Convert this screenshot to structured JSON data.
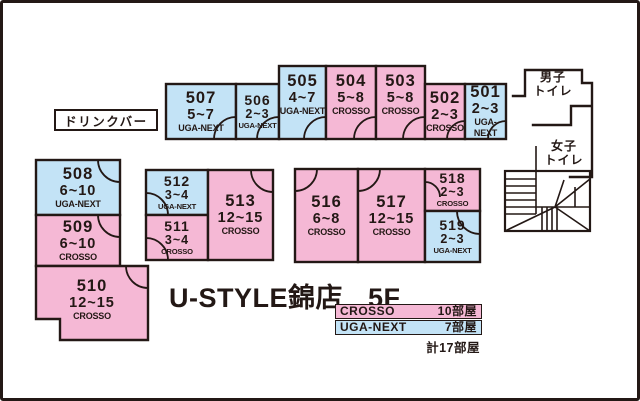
{
  "title": {
    "store": "U-STYLE錦店",
    "floor": "5F"
  },
  "facilities": {
    "drink_bar": "ドリンクバー",
    "mens_toilet_line1": "男子",
    "mens_toilet_line2": "トイレ",
    "womens_toilet_line1": "女子",
    "womens_toilet_line2": "トイレ"
  },
  "colors": {
    "crosso_pink": "#f5b8d5",
    "uga_next_blue": "#c3e3f6",
    "wall": "#231815"
  },
  "rooms": [
    {
      "number": "501",
      "capacity": "2~3",
      "brand": "UGA-NEXT",
      "type": "uga-next"
    },
    {
      "number": "502",
      "capacity": "2~3",
      "brand": "CROSSO",
      "type": "crosso"
    },
    {
      "number": "503",
      "capacity": "5~8",
      "brand": "CROSSO",
      "type": "crosso"
    },
    {
      "number": "504",
      "capacity": "5~8",
      "brand": "CROSSO",
      "type": "crosso"
    },
    {
      "number": "505",
      "capacity": "4~7",
      "brand": "UGA-NEXT",
      "type": "uga-next"
    },
    {
      "number": "506",
      "capacity": "2~3",
      "brand": "UGA-NEXT",
      "type": "uga-next"
    },
    {
      "number": "507",
      "capacity": "5~7",
      "brand": "UGA-NEXT",
      "type": "uga-next"
    },
    {
      "number": "508",
      "capacity": "6~10",
      "brand": "UGA-NEXT",
      "type": "uga-next"
    },
    {
      "number": "509",
      "capacity": "6~10",
      "brand": "CROSSO",
      "type": "crosso"
    },
    {
      "number": "510",
      "capacity": "12~15",
      "brand": "CROSSO",
      "type": "crosso"
    },
    {
      "number": "511",
      "capacity": "3~4",
      "brand": "CROSSO",
      "type": "crosso"
    },
    {
      "number": "512",
      "capacity": "3~4",
      "brand": "UGA-NEXT",
      "type": "uga-next"
    },
    {
      "number": "513",
      "capacity": "12~15",
      "brand": "CROSSO",
      "type": "crosso"
    },
    {
      "number": "516",
      "capacity": "6~8",
      "brand": "CROSSO",
      "type": "crosso"
    },
    {
      "number": "517",
      "capacity": "12~15",
      "brand": "CROSSO",
      "type": "crosso"
    },
    {
      "number": "518",
      "capacity": "2~3",
      "brand": "CROSSO",
      "type": "crosso"
    },
    {
      "number": "519",
      "capacity": "2~3",
      "brand": "UGA-NEXT",
      "type": "uga-next"
    }
  ],
  "legend": {
    "rows": [
      {
        "brand": "CROSSO",
        "count": "10部屋"
      },
      {
        "brand": "UGA-NEXT",
        "count": "7部屋"
      }
    ],
    "total": "計17部屋"
  }
}
